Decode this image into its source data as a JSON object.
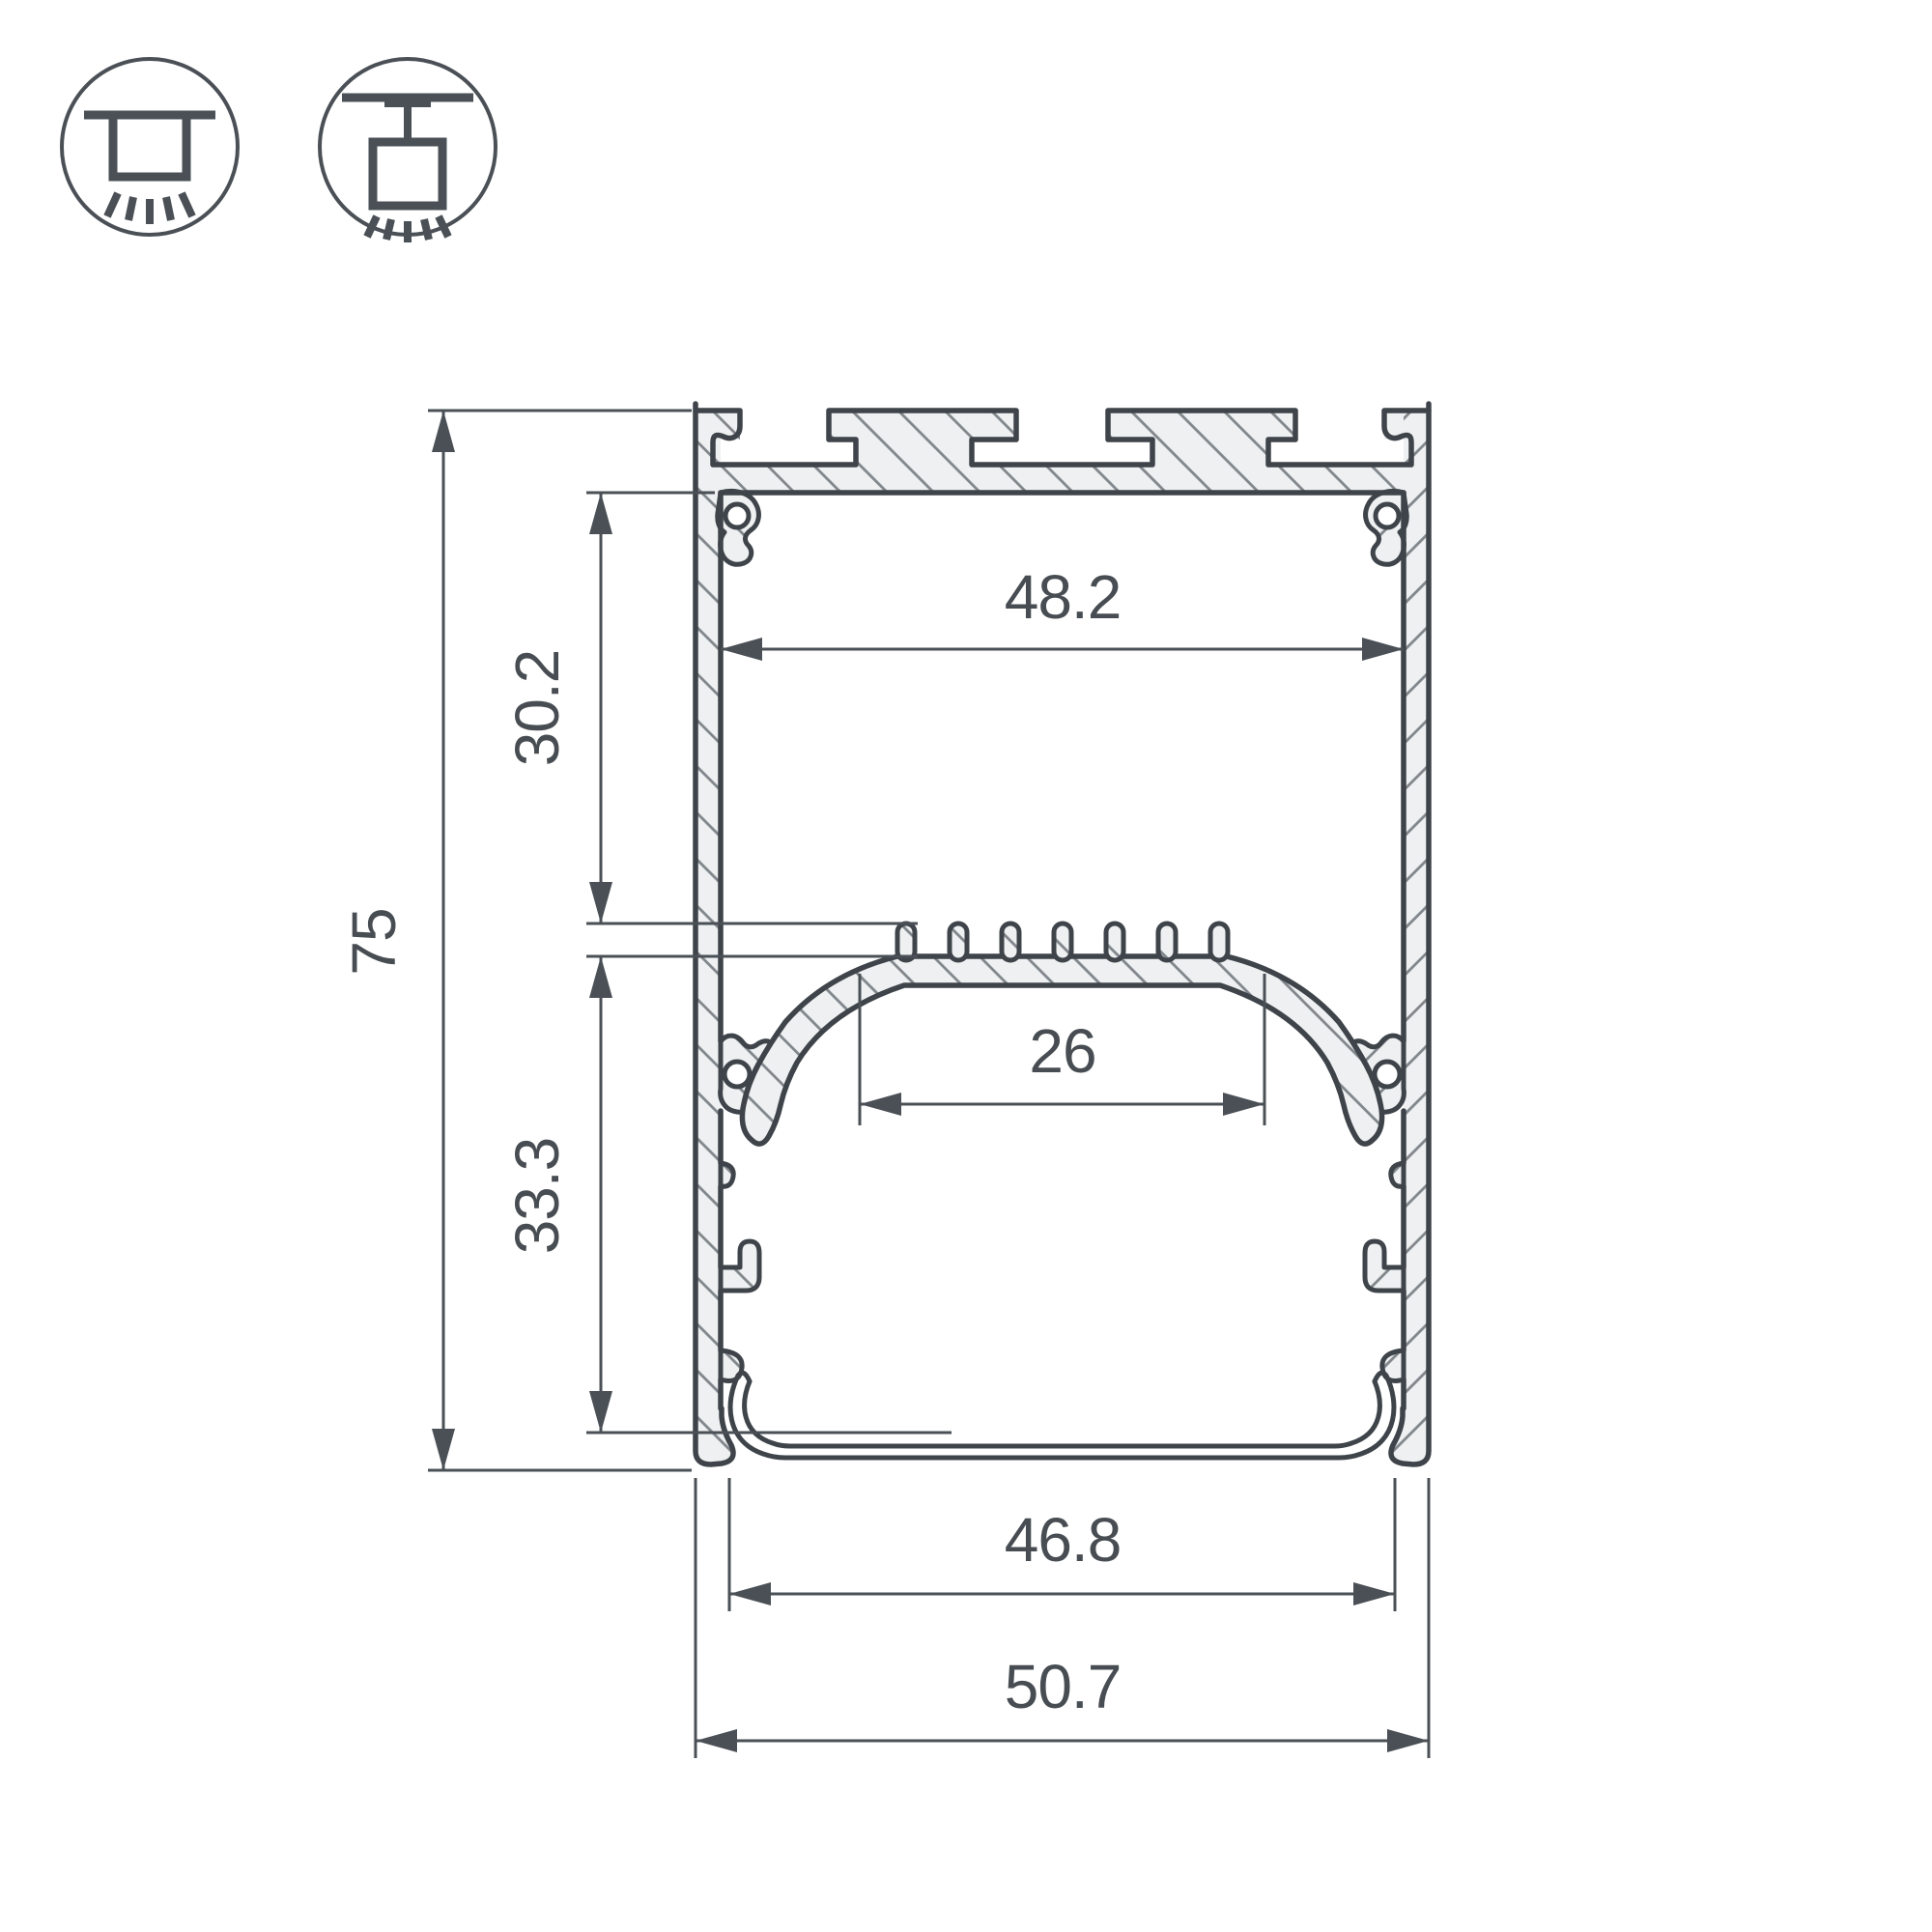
{
  "title": "LED profile cross-section technical drawing",
  "icons": {
    "surface_mount": "surface-mount-icon",
    "pendant_mount": "pendant-mount-icon"
  },
  "dimensions": {
    "overall_height": "75",
    "top_cavity_depth": "30.2",
    "bottom_cavity_depth": "33.3",
    "inner_top_width": "48.2",
    "platform_width": "26",
    "inner_bottom_width": "46.8",
    "overall_width": "50.7"
  },
  "colors": {
    "line": "#3e444a",
    "dimension": "#4a5056",
    "hatch": "#80868b",
    "material_fill": "#eef0f1",
    "background": "#ffffff"
  }
}
